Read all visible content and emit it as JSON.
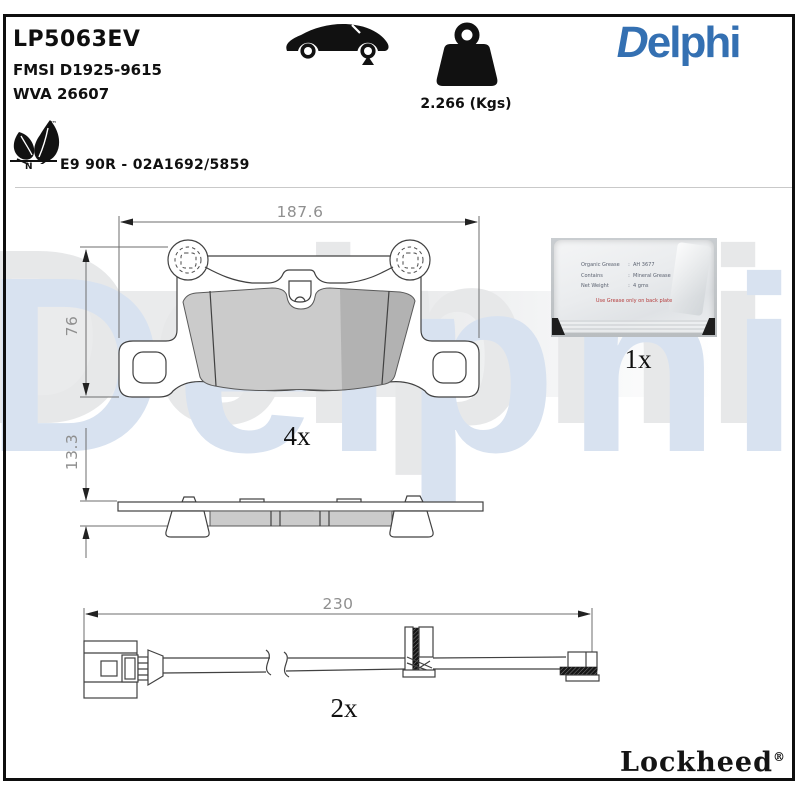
{
  "header": {
    "part_number": "LP5063EV",
    "fmsi_code": "FMSI D1925-9615",
    "wva_code": "WVA 26607",
    "weight": "2.266 (Kgs)",
    "brand_logo": {
      "first": "D",
      "rest": "elphi"
    },
    "eco": {
      "trademark": "™",
      "letter": "N",
      "approval": "E9 90R - 02A1692/5859"
    }
  },
  "pad_front_view": {
    "width_mm": "187.6",
    "height_mm": "76",
    "quantity": "4x"
  },
  "pad_side_view": {
    "thickness_mm": "13.3"
  },
  "wear_sensor": {
    "length_mm": "230",
    "quantity": "2x"
  },
  "grease_sachet": {
    "quantity": "1x",
    "separator": ":",
    "rows": [
      {
        "label": "Organic Grease",
        "value": "AH 3677"
      },
      {
        "label": "Contains",
        "value": "Mineral Grease"
      },
      {
        "label": "Net Weight",
        "value": "4 gms"
      }
    ],
    "warning": "Use Grease only on back plate"
  },
  "footer": {
    "brand": "Lockheed",
    "registered": "®"
  },
  "watermark": {
    "text": "Delphi"
  },
  "colors": {
    "brand_blue": "#3470b2",
    "watermark_blue": "#d8e2f0",
    "watermark_gray": "#e7e8e9",
    "band_gray": "#eaebec",
    "line_dark": "#414141",
    "dimension_gray": "#8f8f8f",
    "friction_gray": "#cbcbcb"
  }
}
